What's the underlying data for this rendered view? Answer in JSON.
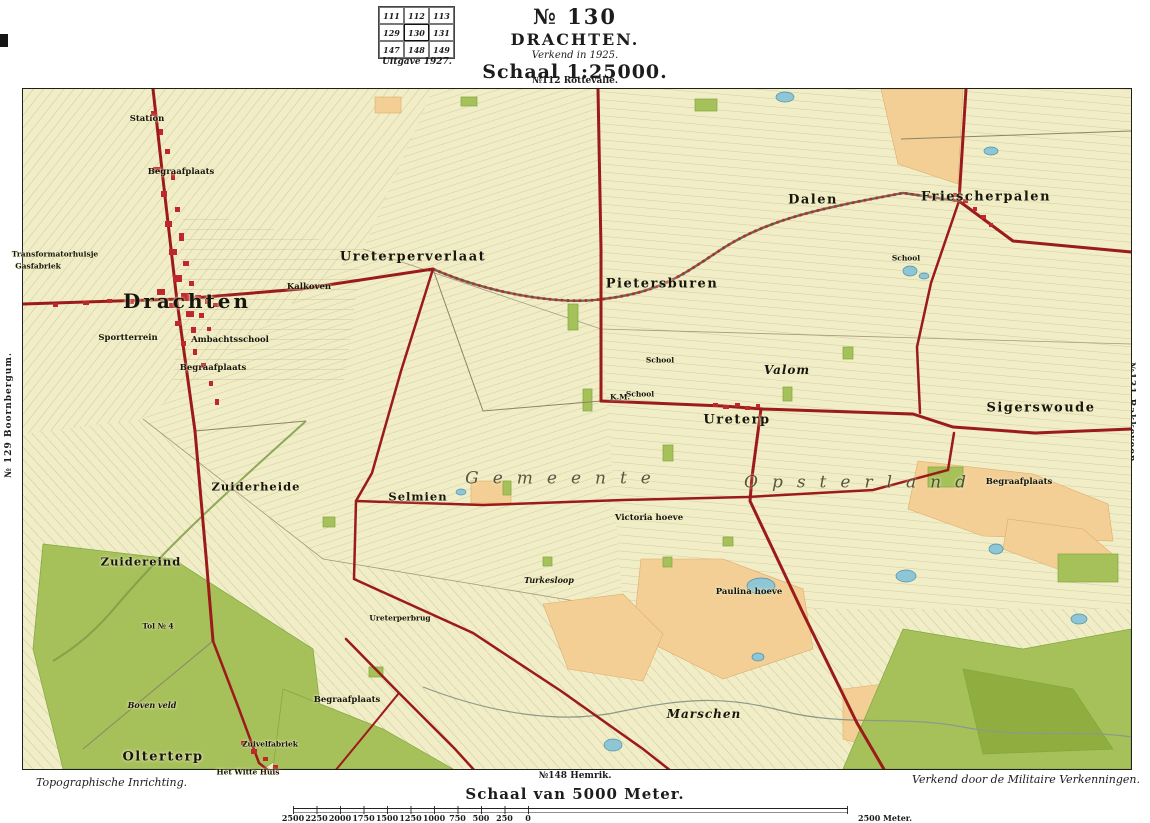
{
  "header": {
    "sheet_number": "№ 130",
    "title": "DRACHTEN.",
    "surveyed": "Verkend in 1925.",
    "scale": "Schaal 1:25000.",
    "index_grid": {
      "cells": [
        [
          "111",
          "112",
          "113"
        ],
        [
          "129",
          "130",
          "131"
        ],
        [
          "147",
          "148",
          "149"
        ]
      ],
      "current": "130",
      "caption": "Uitgave 1927."
    }
  },
  "edges": {
    "top": "№112 Rottevalle.",
    "left": "№ 129 Boornbergum.",
    "right": "№131 Bakkeveen.",
    "bottom": "№148 Hemrik."
  },
  "footer": {
    "credit_left": "Topographische Inrichting.",
    "credit_right": "Verkend door de Militaire Verkenningen.",
    "scale_caption": "Schaal van 5000 Meter.",
    "scale_ticks": [
      "2500",
      "2250",
      "2000",
      "1750",
      "1500",
      "1250",
      "1000",
      "750",
      "500",
      "250",
      "0"
    ],
    "scale_end_label": "2500 Meter."
  },
  "map": {
    "colors": {
      "map_base": "#f1edc6",
      "road_red": "#9b1b1b",
      "town_red": "#c0272d",
      "wood_green": "#a6c05a",
      "sand_orange": "#f3cf96",
      "water_blue": "#8fc6d5",
      "ink": "#1c1c1c"
    },
    "labels": [
      {
        "text": "Drachten",
        "x": 187,
        "y": 301,
        "cls": "town"
      },
      {
        "text": "Ureterperverlaat",
        "x": 413,
        "y": 257,
        "cls": "village"
      },
      {
        "text": "Pietersburen",
        "x": 662,
        "y": 284,
        "cls": "village"
      },
      {
        "text": "Dalen",
        "x": 813,
        "y": 200,
        "cls": "village"
      },
      {
        "text": "Friescherpalen",
        "x": 986,
        "y": 197,
        "cls": "village"
      },
      {
        "text": "Sigerswoude",
        "x": 1041,
        "y": 408,
        "cls": "village"
      },
      {
        "text": "Ureterp",
        "x": 737,
        "y": 420,
        "cls": "village"
      },
      {
        "text": "Olterterp",
        "x": 163,
        "y": 757,
        "cls": "village"
      },
      {
        "text": "Valom",
        "x": 787,
        "y": 370,
        "cls": "hamlet-i"
      },
      {
        "text": "Zuiderheide",
        "x": 256,
        "y": 487,
        "cls": "hamlet"
      },
      {
        "text": "Selmien",
        "x": 418,
        "y": 497,
        "cls": "hamlet"
      },
      {
        "text": "Zuidereind",
        "x": 141,
        "y": 562,
        "cls": "hamlet"
      },
      {
        "text": "Marschen",
        "x": 704,
        "y": 714,
        "cls": "hamlet-i"
      },
      {
        "text": "Gemeente",
        "x": 565,
        "y": 479,
        "cls": "spread"
      },
      {
        "text": "Opsterland",
        "x": 862,
        "y": 483,
        "cls": "spread"
      },
      {
        "text": "Station",
        "x": 147,
        "y": 119,
        "cls": "small"
      },
      {
        "text": "Begraafplaats",
        "x": 181,
        "y": 172,
        "cls": "small"
      },
      {
        "text": "Sportterrein",
        "x": 128,
        "y": 338,
        "cls": "small"
      },
      {
        "text": "Ambachtsschool",
        "x": 230,
        "y": 340,
        "cls": "small"
      },
      {
        "text": "Begraafplaats",
        "x": 213,
        "y": 368,
        "cls": "small"
      },
      {
        "text": "Kalkoven",
        "x": 309,
        "y": 287,
        "cls": "small"
      },
      {
        "text": "Transformatorhuisje",
        "x": 55,
        "y": 254,
        "cls": "tiny"
      },
      {
        "text": "Gasfabriek",
        "x": 38,
        "y": 266,
        "cls": "tiny"
      },
      {
        "text": "School",
        "x": 660,
        "y": 360,
        "cls": "tiny"
      },
      {
        "text": "School",
        "x": 906,
        "y": 258,
        "cls": "tiny"
      },
      {
        "text": "School",
        "x": 640,
        "y": 394,
        "cls": "tiny"
      },
      {
        "text": "Victoria hoeve",
        "x": 649,
        "y": 518,
        "cls": "small"
      },
      {
        "text": "Paulina hoeve",
        "x": 749,
        "y": 592,
        "cls": "small"
      },
      {
        "text": "Turkesloop",
        "x": 549,
        "y": 580,
        "cls": "tiny-i"
      },
      {
        "text": "Begraafplaats",
        "x": 347,
        "y": 700,
        "cls": "small"
      },
      {
        "text": "Begraafplaats",
        "x": 1019,
        "y": 482,
        "cls": "small"
      },
      {
        "text": "Het Witte Huis",
        "x": 248,
        "y": 772,
        "cls": "tiny"
      },
      {
        "text": "Zuivelfabriek",
        "x": 270,
        "y": 744,
        "cls": "tiny"
      },
      {
        "text": "Boven veld",
        "x": 152,
        "y": 705,
        "cls": "tiny-i"
      },
      {
        "text": "Tol № 4",
        "x": 158,
        "y": 626,
        "cls": "tiny"
      },
      {
        "text": "Ureterperbrug",
        "x": 400,
        "y": 618,
        "cls": "tiny"
      },
      {
        "text": "K.M.",
        "x": 620,
        "y": 397,
        "cls": "tiny"
      }
    ]
  }
}
